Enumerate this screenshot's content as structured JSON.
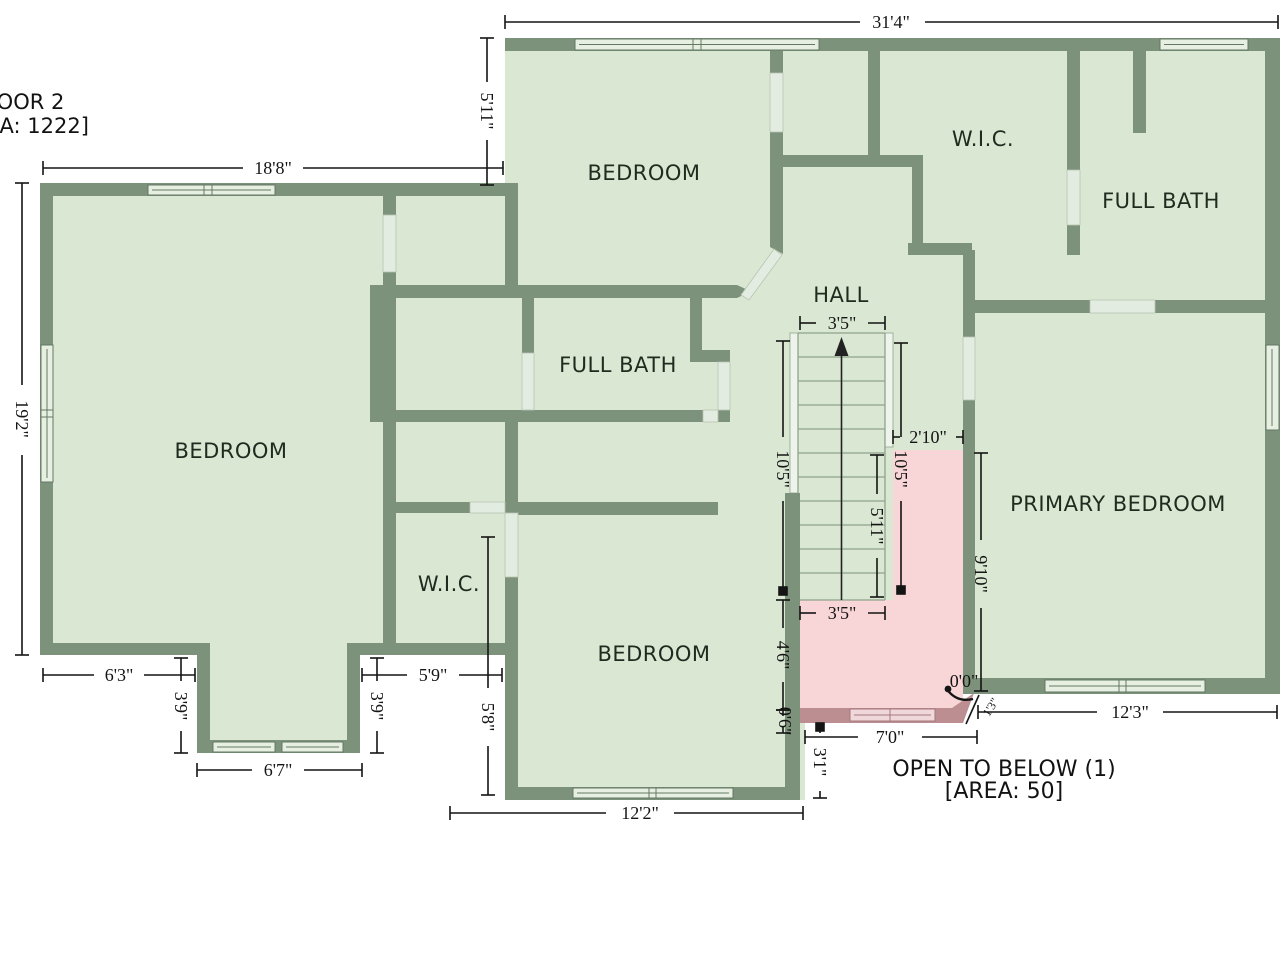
{
  "title": {
    "line1": "FLOOR 2",
    "line2": "[AREA: 1222]"
  },
  "rooms": [
    {
      "id": "bedroom-top",
      "text": "BEDROOM"
    },
    {
      "id": "wic-top",
      "text": "W.I.C."
    },
    {
      "id": "full-bath-top",
      "text": "FULL BATH"
    },
    {
      "id": "hall",
      "text": "HALL"
    },
    {
      "id": "bedroom-left",
      "text": "BEDROOM"
    },
    {
      "id": "full-bath-mid",
      "text": "FULL BATH"
    },
    {
      "id": "primary-bedroom",
      "text": "PRIMARY BEDROOM"
    },
    {
      "id": "wic-bottom",
      "text": "W.I.C."
    },
    {
      "id": "bedroom-bottom",
      "text": "BEDROOM"
    }
  ],
  "open_below": {
    "line1": "OPEN TO BELOW (1)",
    "line2": "[AREA: 50]"
  },
  "dimensions": {
    "d1": "31'4\"",
    "d2": "18'8\"",
    "d3": "5'11\"",
    "d4": "19'2\"",
    "d5": "6'3\"",
    "d6": "3'9\"",
    "d7": "6'7\"",
    "d8": "3'9\"",
    "d9": "5'9\"",
    "d10": "5'8\"",
    "d11": "12'2\"",
    "d12": "3'5\"",
    "d13": "10'5\"",
    "d14": "10'5\"",
    "d15": "5'11\"",
    "d16": "2'10\"",
    "d17": "3'5\"",
    "d18": "4'6\"",
    "d19": "0'6\"",
    "d20": "3'1\"",
    "d21": "7'0\"",
    "d22": "9'10\"",
    "d23": "12'3\"",
    "d24": "0'0\"",
    "d25": "1'3\""
  },
  "colors": {
    "wall": "#7d927b",
    "floor": "#d9e7d3",
    "open_below_floor": "#f8d6d7",
    "open_below_wall": "#bc8e91",
    "window": "#e7efe3",
    "dimension": "#141414"
  }
}
